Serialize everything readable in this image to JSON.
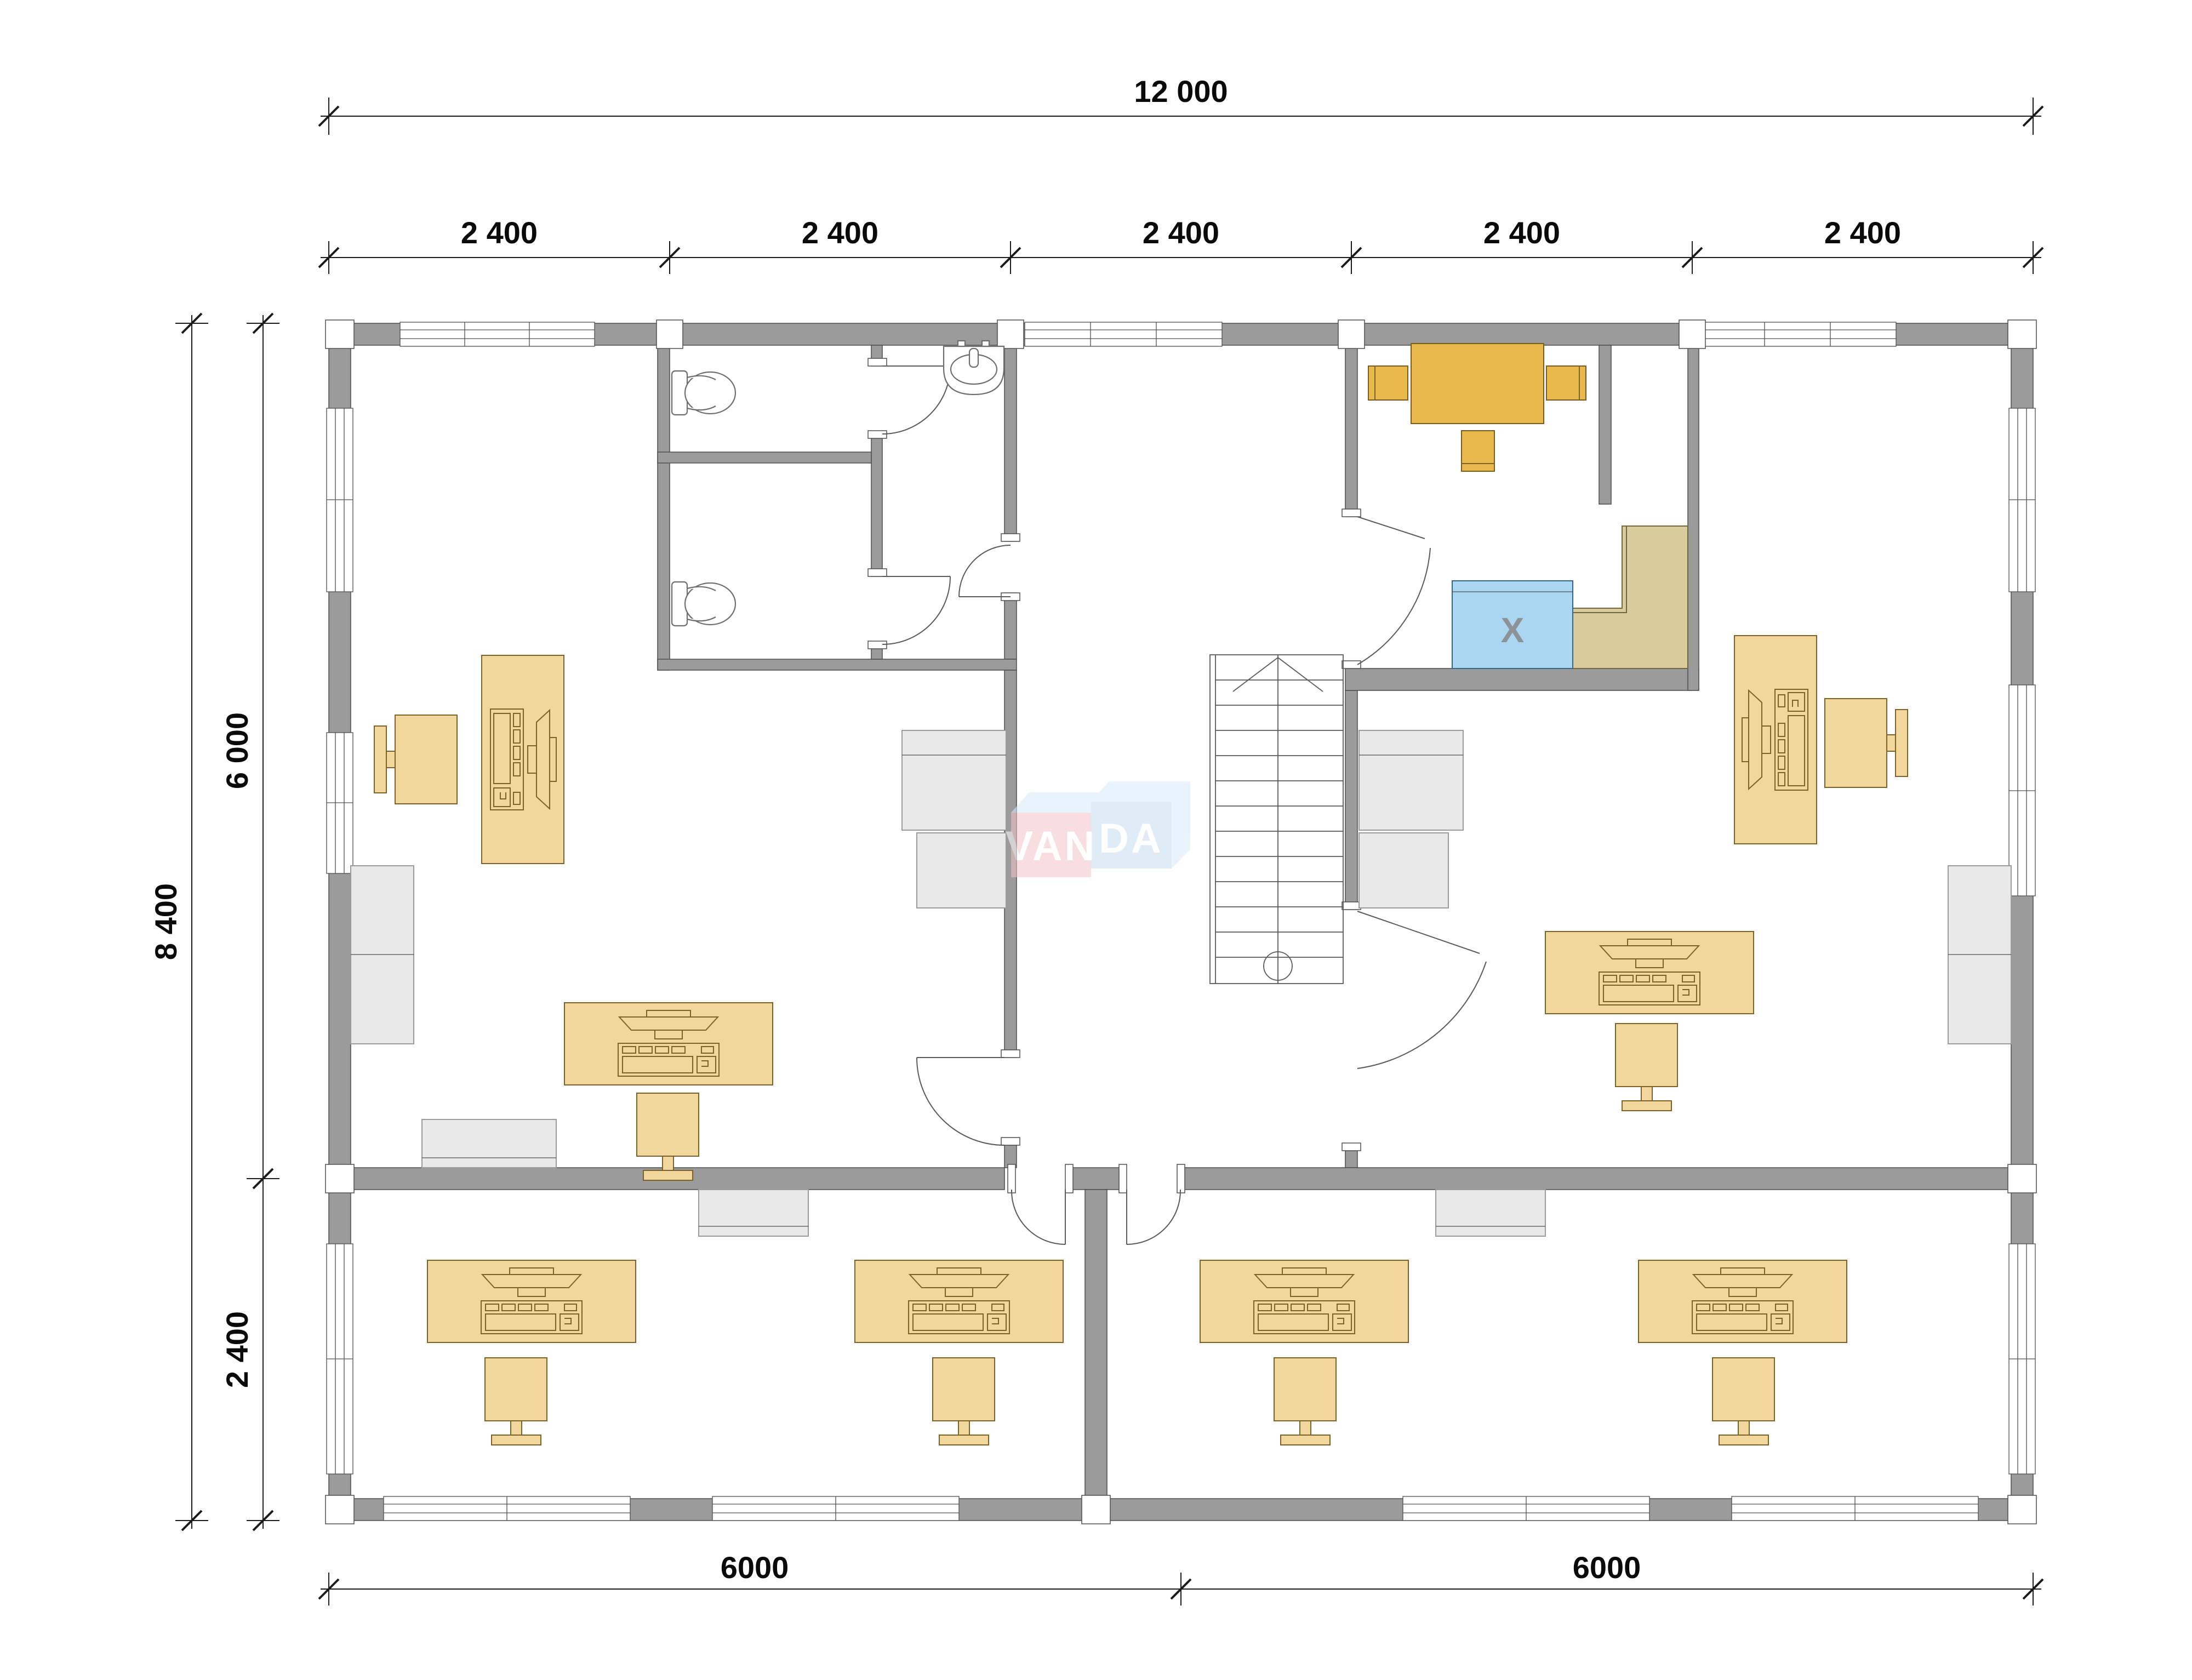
{
  "title": "office-floor-plan",
  "dimensions": {
    "top_total": "12 000",
    "top_bays": [
      "2 400",
      "2 400",
      "2 400",
      "2 400",
      "2 400"
    ],
    "left_total": "8 400",
    "left_upper": "6 000",
    "left_lower": "2 400",
    "bottom_left": "6000",
    "bottom_right": "6000"
  },
  "logo": {
    "part1": "VAN",
    "part2": "DA"
  },
  "labels": {
    "appliance": "X"
  },
  "colors": {
    "wall": "#9b9b9b",
    "wall-edge": "#4f4f4f",
    "furn": "#f2d79c",
    "furn-edge": "#7a6228",
    "table": "#eab94d",
    "table-edge": "#7a5c1e",
    "gray-furn": "#e9e9e9",
    "gray-edge": "#9b9b9b",
    "blue": "#abd6f2",
    "blue-edge": "#36648e",
    "counter": "#d9cb9b",
    "counter-edge": "#6f6742",
    "logo-pink": "#f3c3ca",
    "logo-blue": "#c6ddf0",
    "logo-shadow": "#d8ebf8"
  }
}
